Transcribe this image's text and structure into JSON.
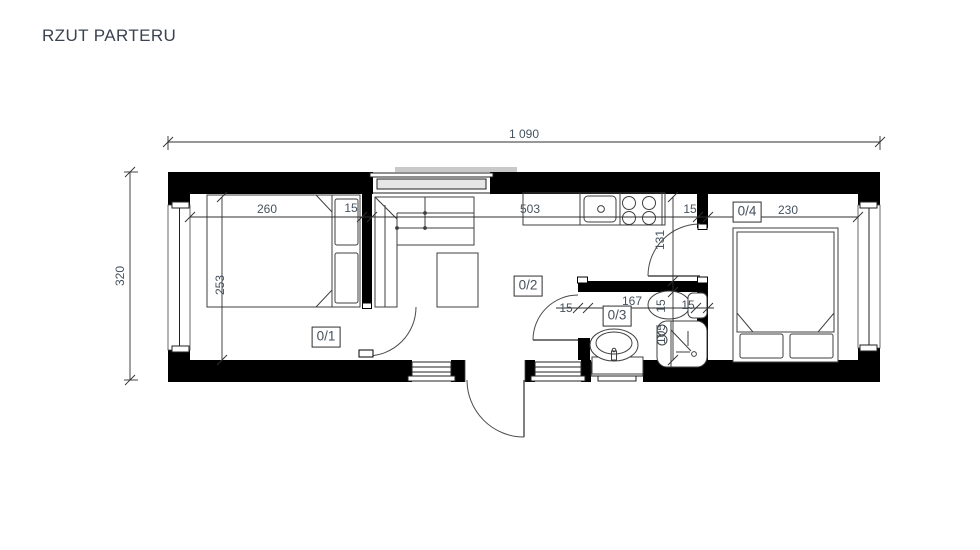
{
  "title": "RZUT PARTERU",
  "dims": {
    "total_width": "1 090",
    "total_depth": "320",
    "bedroom1_width": "260",
    "wall1_thk": "15",
    "living_width": "503",
    "wall2_thk": "15",
    "bedroom2_width": "230",
    "bedroom1_depth": "253",
    "corridor_depth": "131",
    "bath_wall_thk": "15",
    "bath_depth": "105",
    "bath_left_wall_thk": "15",
    "bath_width": "167",
    "bath_right_wall_thk": "15"
  },
  "rooms": {
    "r1": "0/1",
    "r2": "0/2",
    "r3": "0/3",
    "r4": "0/4"
  },
  "colors": {
    "wall": "#000000",
    "furniture_line": "#3f3f3f",
    "dimension_line": "#2f2f2f",
    "dim_text": "#46525e",
    "glazing": "#e6e6e6",
    "roof_edge": "#c9c9c9"
  }
}
